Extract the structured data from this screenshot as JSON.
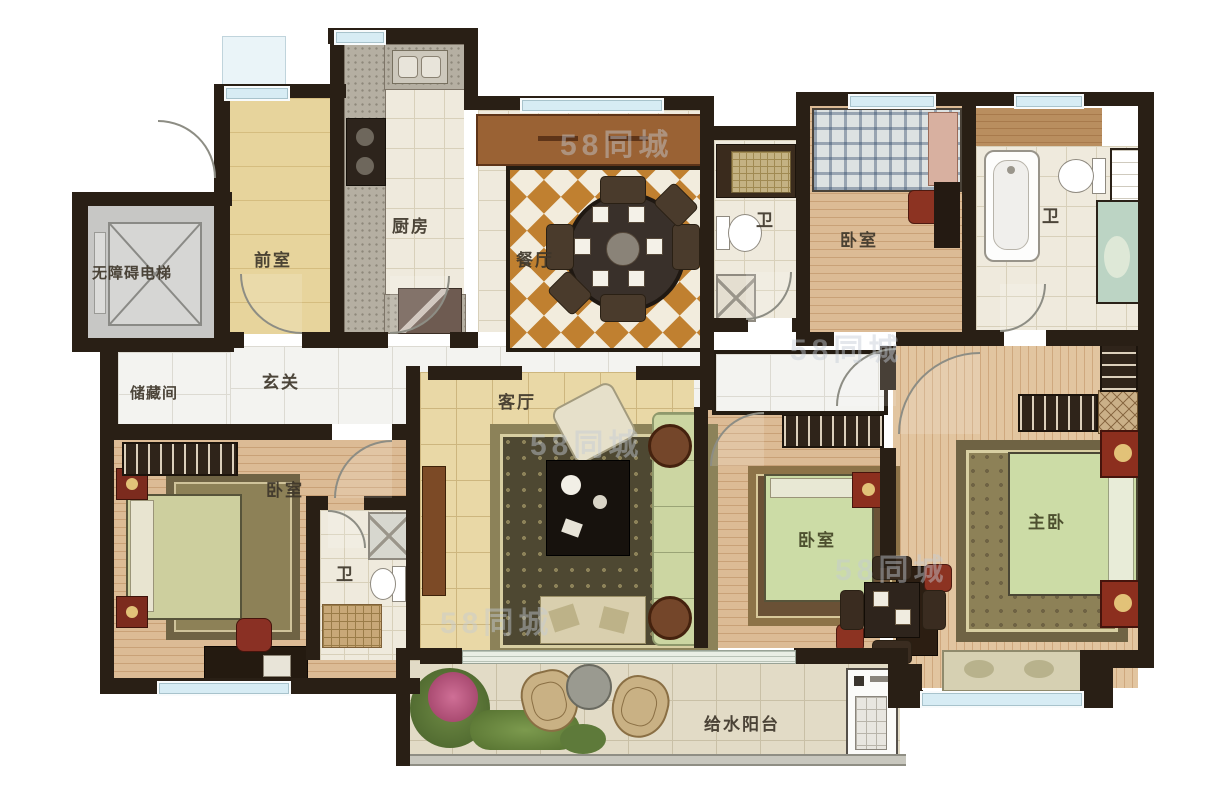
{
  "floorplan": {
    "labels": {
      "elevator": "无障碍电梯",
      "front_room": "前室",
      "kitchen": "厨房",
      "dining": "餐厅",
      "bath": "卫",
      "bedroom": "卧室",
      "storage": "储藏间",
      "foyer": "玄关",
      "living": "客厅",
      "master_bedroom": "主卧",
      "balcony": "给水阳台"
    },
    "watermark": "58同城",
    "colors": {
      "wall": "#291f15",
      "wood_plank": "#dcbb95",
      "marble": "#f3f3f0",
      "gold_tile": "#e9d8a6",
      "checker_orange": "#c08030",
      "window_glass": "#d7ecf4",
      "accent_red": "#8c3120",
      "blanket_green": "#cfdca6",
      "sofa_green": "#ccd6a2"
    }
  }
}
